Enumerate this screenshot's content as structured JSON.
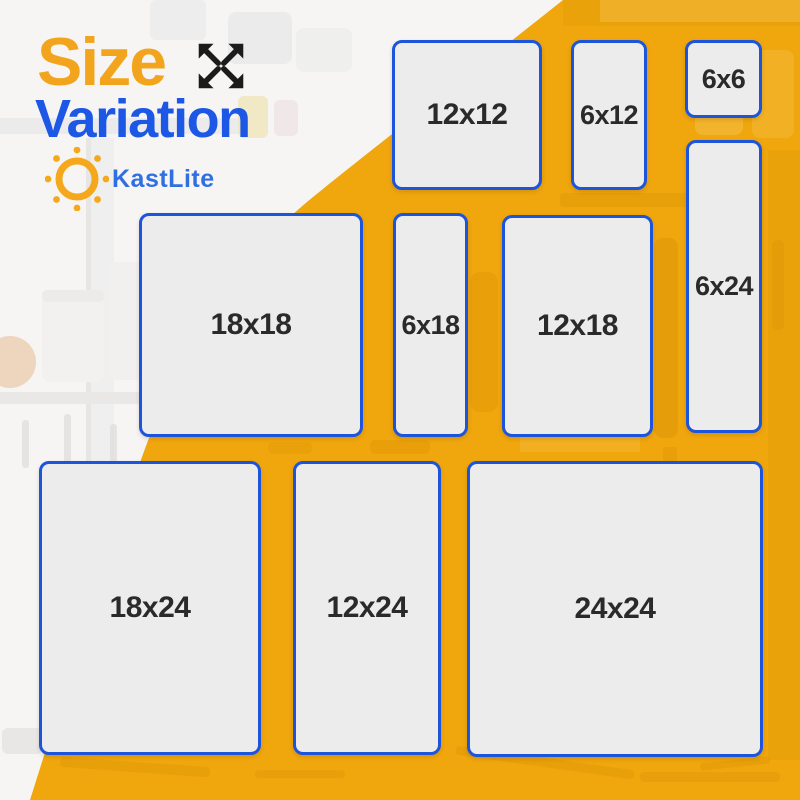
{
  "header": {
    "title_line1": "Size",
    "title_line2": "Variation",
    "brand": "KastLite",
    "icons": {
      "expand": "expand-arrows-icon",
      "sun": "sun-icon"
    }
  },
  "panels": [
    {
      "label": "12x12",
      "width_in": 12,
      "height_in": 12
    },
    {
      "label": "6x12",
      "width_in": 6,
      "height_in": 12
    },
    {
      "label": "6x6",
      "width_in": 6,
      "height_in": 6
    },
    {
      "label": "18x18",
      "width_in": 18,
      "height_in": 18
    },
    {
      "label": "6x18",
      "width_in": 6,
      "height_in": 18
    },
    {
      "label": "12x18",
      "width_in": 12,
      "height_in": 18
    },
    {
      "label": "6x24",
      "width_in": 6,
      "height_in": 24
    },
    {
      "label": "18x24",
      "width_in": 18,
      "height_in": 24
    },
    {
      "label": "12x24",
      "width_in": 12,
      "height_in": 24
    },
    {
      "label": "24x24",
      "width_in": 24,
      "height_in": 24
    }
  ],
  "colors": {
    "background_orange": "#F0A60D",
    "panel_fill": "#ECECEC",
    "panel_border": "#1C55DC",
    "title_orange": "#F2A51C",
    "title_blue": "#1C57E6",
    "brand_blue": "#2F6FE2",
    "label_text": "#2A2A2A",
    "white_area": "#F6F5F4"
  }
}
